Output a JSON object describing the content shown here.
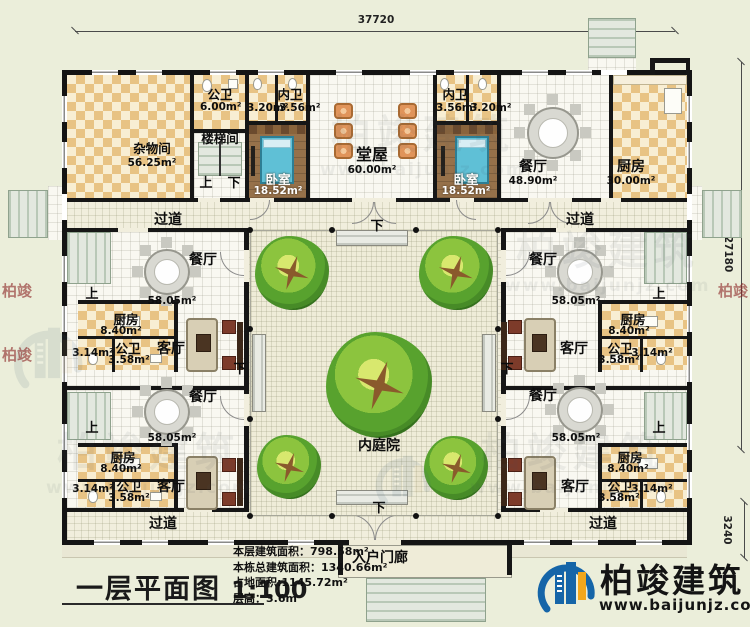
{
  "meta": {
    "plan_title": "一层平面图",
    "plan_scale": "1:100"
  },
  "dims": {
    "top": "37720",
    "right": "27180",
    "right_lower": "3240"
  },
  "stats": {
    "l1": "本层建筑面积：798.58m²",
    "l2": "本栋总建筑面积：1340.66m²",
    "l3": "占地面积:1145.72m²",
    "l4": "层高：3.6m"
  },
  "branding": {
    "name": "柏竣建筑",
    "site": "www.baijunjz.com"
  },
  "watermark": {
    "name": "柏竣建筑",
    "site": "www.baijunjz.com"
  },
  "nav": {
    "up": "上",
    "down": "下"
  },
  "rooms": {
    "storage": {
      "name": "杂物间",
      "area": "56.25m²"
    },
    "pubbath_n": {
      "name": "公卫",
      "area": "6.00m²"
    },
    "stairwell": {
      "name": "楼梯间"
    },
    "ensuite_l": {
      "name": "内卫",
      "area_left": "3.20m²",
      "area_right": "3.56m²"
    },
    "ensuite_r": {
      "name": "内卫",
      "area_left": "3.56m²",
      "area_right": "3.20m²"
    },
    "bedroom": {
      "name": "卧室",
      "area": "18.52m²"
    },
    "hall": {
      "name": "堂屋",
      "area": "60.00m²"
    },
    "dining_n": {
      "name": "餐厅",
      "area": "48.90m²"
    },
    "kitchen_n": {
      "name": "厨房",
      "area": "30.00m²"
    },
    "wing_dining": {
      "name": "餐厅",
      "area": "58.05m²"
    },
    "wing_kitchen": {
      "name": "厨房",
      "area": "8.40m²"
    },
    "wing_bath": {
      "name": "公卫",
      "area_main": "3.58m²",
      "area_small": "3.14m²"
    },
    "wing_living": {
      "name": "客厅"
    },
    "corridor": {
      "name": "过道"
    },
    "courtyard": {
      "name": "内庭院"
    },
    "porch": {
      "name": "入户门廊"
    }
  }
}
